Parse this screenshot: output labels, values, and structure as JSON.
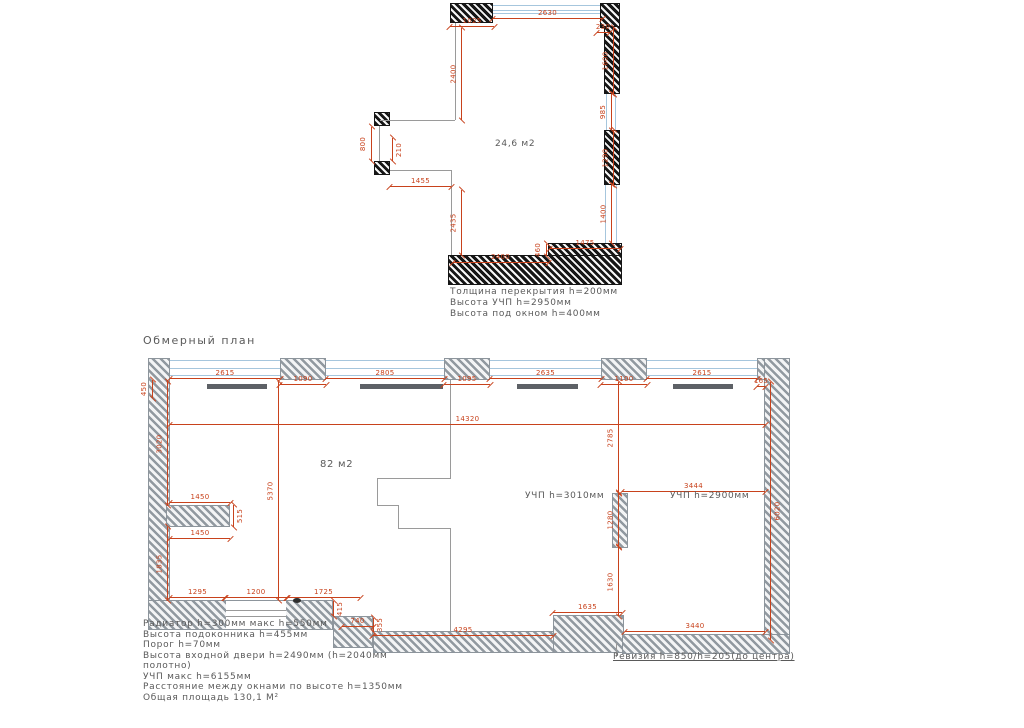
{
  "title": "Обмерный план",
  "colors": {
    "dim": "#c8421c",
    "window": "#a6c6dd",
    "text": "#5a5a5a",
    "interior_line": "#9a9a9a",
    "radiator": "#5d6166"
  },
  "plan_top": {
    "wall_style": "black",
    "room_label": {
      "t": "24,6  м2",
      "x": 495,
      "y": 139,
      "fs": 9
    },
    "notes": {
      "x": 450,
      "y": 287,
      "fs": 9,
      "lh": 11,
      "lines": [
        "Толщина перекрытия h=200мм",
        "Высота УЧП h=2950мм",
        "Высота под окном h=400мм"
      ]
    },
    "walls": [
      [
        450,
        3,
        43,
        20
      ],
      [
        600,
        3,
        20,
        25
      ],
      [
        604,
        26,
        16,
        68
      ],
      [
        604,
        130,
        16,
        55
      ],
      [
        548,
        243,
        74,
        14
      ],
      [
        448,
        255,
        174,
        30
      ],
      [
        374,
        112,
        16,
        14
      ],
      [
        374,
        161,
        16,
        14
      ]
    ],
    "windows": [
      {
        "r": [
          493,
          5,
          107,
          9
        ],
        "o": "h"
      },
      {
        "r": [
          606,
          94,
          10,
          36
        ],
        "o": "v"
      },
      {
        "r": [
          605,
          185,
          12,
          58
        ],
        "o": "v"
      }
    ],
    "lines": [
      [
        455,
        23,
        1,
        97
      ],
      [
        380,
        120,
        75,
        1
      ],
      [
        379,
        126,
        1,
        35
      ],
      [
        390,
        170,
        62,
        1
      ],
      [
        451,
        170,
        1,
        85
      ]
    ],
    "dims": [
      {
        "x": 493,
        "y": 18,
        "l": 109,
        "o": "h",
        "t": "2630"
      },
      {
        "x": 450,
        "y": 26,
        "l": 44,
        "o": "h",
        "t": "1025"
      },
      {
        "x": 597,
        "y": 32,
        "l": 12,
        "o": "h",
        "t": "230"
      },
      {
        "x": 461,
        "y": 28,
        "l": 92,
        "o": "v",
        "t": "2400"
      },
      {
        "x": 613,
        "y": 28,
        "l": 66,
        "o": "v",
        "t": "1600"
      },
      {
        "x": 611,
        "y": 94,
        "l": 36,
        "o": "v",
        "t": "985"
      },
      {
        "x": 613,
        "y": 130,
        "l": 55,
        "o": "v",
        "t": "1290"
      },
      {
        "x": 611,
        "y": 185,
        "l": 58,
        "o": "v",
        "t": "1400"
      },
      {
        "x": 371,
        "y": 127,
        "l": 34,
        "o": "v",
        "t": "800"
      },
      {
        "x": 392,
        "y": 138,
        "l": 23,
        "o": "v",
        "t": "210",
        "s": "r"
      },
      {
        "x": 390,
        "y": 186,
        "l": 61,
        "o": "h",
        "t": "1455"
      },
      {
        "x": 461,
        "y": 190,
        "l": 65,
        "o": "v",
        "t": "2435"
      },
      {
        "x": 453,
        "y": 262,
        "l": 95,
        "o": "h",
        "t": "2400"
      },
      {
        "x": 546,
        "y": 244,
        "l": 12,
        "o": "v",
        "t": "460"
      },
      {
        "x": 550,
        "y": 248,
        "l": 70,
        "o": "h",
        "t": "1475"
      }
    ]
  },
  "plan_bottom": {
    "wall_style": "gray",
    "room_labels": [
      {
        "t": "82  м2",
        "x": 320,
        "y": 459,
        "fs": 10
      },
      {
        "t": "УЧП  h=3010мм",
        "x": 525,
        "y": 491,
        "fs": 9
      },
      {
        "t": "УЧП  h=2900мм",
        "x": 670,
        "y": 491,
        "fs": 9
      }
    ],
    "revision_note": {
      "t": "Ревизия  h=850/h=205(до  центра)",
      "x": 613,
      "y": 652,
      "fs": 9
    },
    "legend": {
      "x": 143,
      "y": 619,
      "fs": 9,
      "lh": 10.5,
      "lines": [
        "Радиатор  h=300мм  макс  h=550мм",
        "Высота  подоконника  h=455мм",
        "Порог  h=70мм",
        "Высота  входной  двери  h=2490мм  (h=2040мм",
        "полотно)",
        "УЧП  макс  h=6155мм",
        "Расстояние  между  окнами  по  высоте  h=1350мм",
        "Общая  площадь  130,1 М²"
      ]
    },
    "walls": [
      [
        148,
        358,
        22,
        272
      ],
      [
        280,
        358,
        46,
        22
      ],
      [
        444,
        358,
        46,
        22
      ],
      [
        601,
        358,
        46,
        22
      ],
      [
        757,
        358,
        33,
        22
      ],
      [
        764,
        358,
        26,
        296
      ],
      [
        166,
        505,
        64,
        22
      ],
      [
        148,
        600,
        185,
        30
      ],
      [
        333,
        616,
        40,
        32
      ],
      [
        373,
        631,
        182,
        22
      ],
      [
        553,
        615,
        71,
        38
      ],
      [
        622,
        634,
        168,
        20
      ],
      [
        612,
        493,
        16,
        55
      ]
    ],
    "door_gap": [
      226,
      601,
      60,
      28
    ],
    "door_mark": [
      293,
      598,
      8,
      5
    ],
    "windows": [
      {
        "r": [
          170,
          360,
          110,
          16
        ],
        "o": "h"
      },
      {
        "r": [
          326,
          360,
          118,
          16
        ],
        "o": "h"
      },
      {
        "r": [
          490,
          360,
          111,
          16
        ],
        "o": "h"
      },
      {
        "r": [
          647,
          360,
          110,
          16
        ],
        "o": "h"
      }
    ],
    "radiators": [
      [
        207,
        384,
        60,
        5
      ],
      [
        360,
        384,
        83,
        5
      ],
      [
        517,
        384,
        61,
        5
      ],
      [
        673,
        384,
        60,
        5
      ]
    ],
    "lines": [
      [
        450,
        380,
        1,
        98
      ],
      [
        450,
        528,
        1,
        103
      ],
      [
        377,
        478,
        74,
        1
      ],
      [
        377,
        478,
        1,
        28
      ],
      [
        377,
        505,
        22,
        1
      ],
      [
        398,
        505,
        1,
        24
      ],
      [
        398,
        528,
        53,
        1
      ],
      [
        226,
        610,
        60,
        1
      ],
      [
        226,
        616,
        60,
        1
      ],
      [
        616,
        643,
        1,
        14
      ]
    ],
    "dims": [
      {
        "x": 170,
        "y": 424,
        "l": 595,
        "o": "h",
        "t": "14320"
      },
      {
        "x": 170,
        "y": 378,
        "l": 110,
        "o": "h",
        "t": "2615"
      },
      {
        "x": 280,
        "y": 384,
        "l": 46,
        "o": "h",
        "t": "1090"
      },
      {
        "x": 326,
        "y": 378,
        "l": 118,
        "o": "h",
        "t": "2805"
      },
      {
        "x": 444,
        "y": 384,
        "l": 46,
        "o": "h",
        "t": "1095"
      },
      {
        "x": 490,
        "y": 378,
        "l": 111,
        "o": "h",
        "t": "2635"
      },
      {
        "x": 601,
        "y": 384,
        "l": 46,
        "o": "h",
        "t": "1100"
      },
      {
        "x": 647,
        "y": 378,
        "l": 110,
        "o": "h",
        "t": "2615"
      },
      {
        "x": 757,
        "y": 386,
        "l": 8,
        "o": "h",
        "t": "165"
      },
      {
        "x": 152,
        "y": 380,
        "l": 18,
        "o": "v",
        "t": "450"
      },
      {
        "x": 167,
        "y": 382,
        "l": 123,
        "o": "v",
        "t": "3020"
      },
      {
        "x": 167,
        "y": 527,
        "l": 73,
        "o": "v",
        "t": "1835"
      },
      {
        "x": 170,
        "y": 502,
        "l": 60,
        "o": "h",
        "t": "1450"
      },
      {
        "x": 233,
        "y": 505,
        "l": 22,
        "o": "v",
        "t": "515",
        "s": "r"
      },
      {
        "x": 170,
        "y": 538,
        "l": 60,
        "o": "h",
        "t": "1450"
      },
      {
        "x": 278,
        "y": 382,
        "l": 218,
        "o": "v",
        "t": "5370"
      },
      {
        "x": 170,
        "y": 597,
        "l": 55,
        "o": "h",
        "t": "1295"
      },
      {
        "x": 225,
        "y": 597,
        "l": 62,
        "o": "h",
        "t": "1200"
      },
      {
        "x": 287,
        "y": 597,
        "l": 73,
        "o": "h",
        "t": "1725"
      },
      {
        "x": 333,
        "y": 601,
        "l": 15,
        "o": "v",
        "t": "415",
        "s": "r"
      },
      {
        "x": 342,
        "y": 626,
        "l": 31,
        "o": "h",
        "t": "740"
      },
      {
        "x": 373,
        "y": 618,
        "l": 14,
        "o": "v",
        "t": "355",
        "s": "r"
      },
      {
        "x": 373,
        "y": 635,
        "l": 180,
        "o": "h",
        "t": "4295"
      },
      {
        "x": 553,
        "y": 612,
        "l": 69,
        "o": "h",
        "t": "1635"
      },
      {
        "x": 625,
        "y": 631,
        "l": 140,
        "o": "h",
        "t": "3440"
      },
      {
        "x": 618,
        "y": 382,
        "l": 111,
        "o": "v",
        "t": "2785"
      },
      {
        "x": 618,
        "y": 493,
        "l": 54,
        "o": "v",
        "t": "1280"
      },
      {
        "x": 618,
        "y": 547,
        "l": 69,
        "o": "v",
        "t": "1630"
      },
      {
        "x": 622,
        "y": 491,
        "l": 143,
        "o": "h",
        "t": "3444"
      },
      {
        "x": 770,
        "y": 382,
        "l": 258,
        "o": "v",
        "t": "6020",
        "s": "r"
      }
    ]
  }
}
